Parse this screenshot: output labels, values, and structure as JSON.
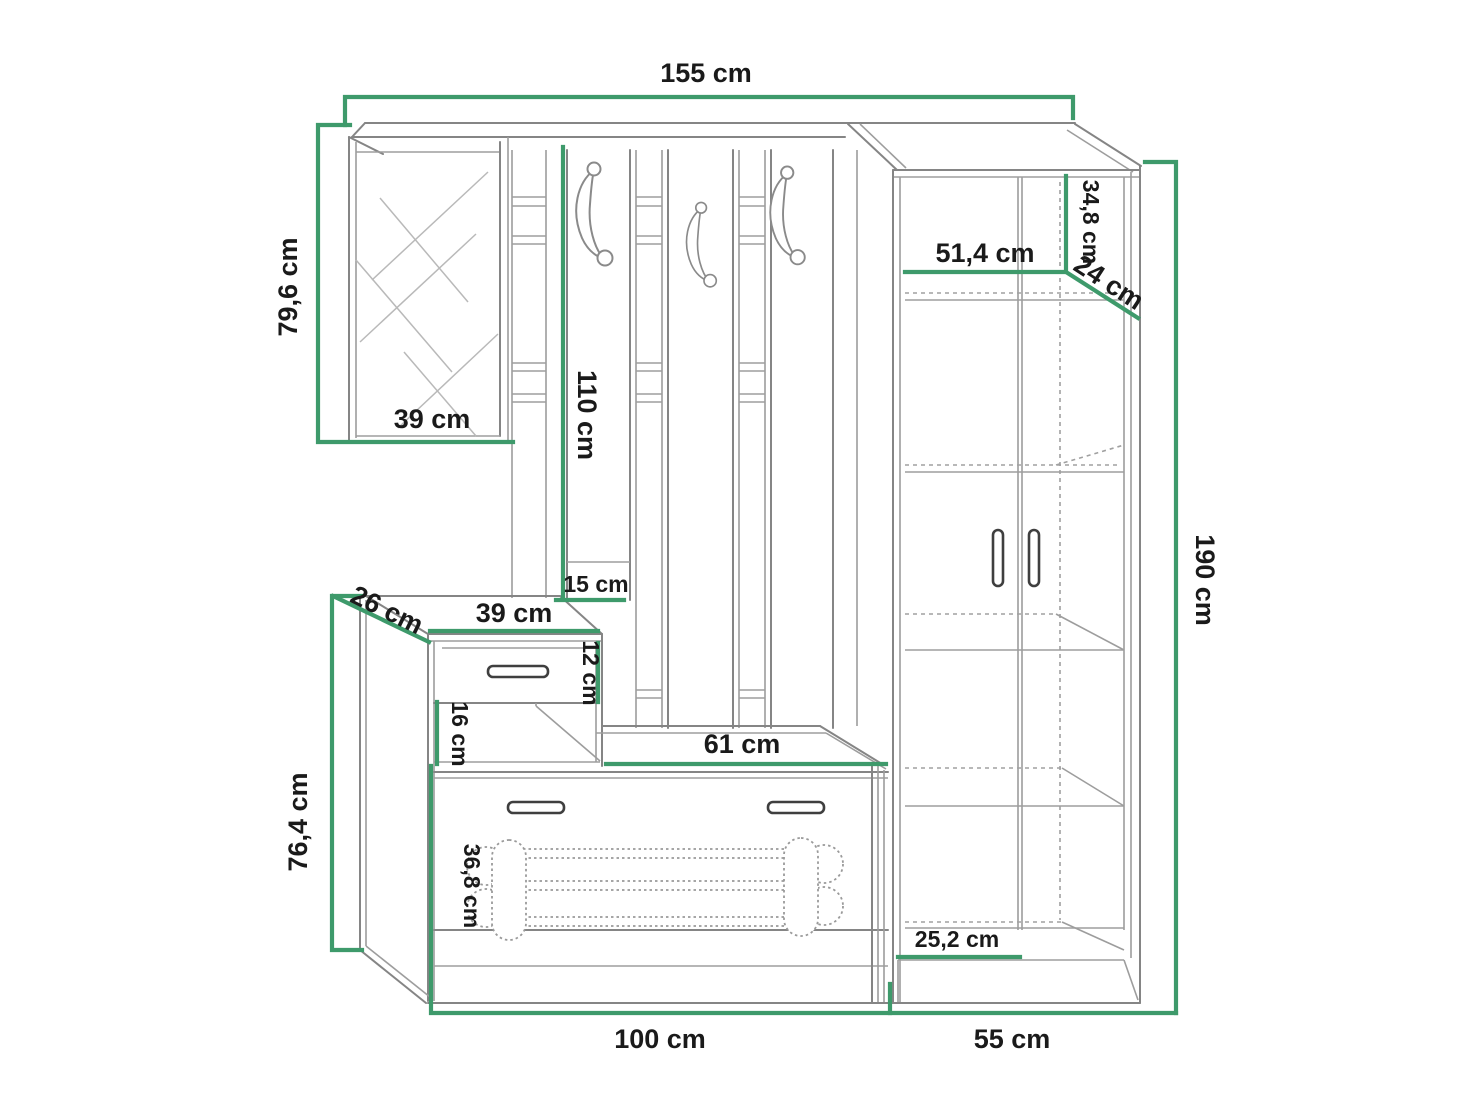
{
  "diagram": {
    "type": "furniture-dimension-drawing",
    "unit": "cm",
    "colors": {
      "dimension_line": "#3E9A6B",
      "furniture_outline": "#858585",
      "label_text": "#1a1a1a",
      "background": "#ffffff"
    },
    "dims": {
      "top_width": "155 cm",
      "mirror_height": "79,6 cm",
      "mirror_width": "39 cm",
      "hook_panel_height": "110 cm",
      "hook_panel_bottom": "15 cm",
      "top_shelf_height": "34,8 cm",
      "shelf_width": "51,4 cm",
      "shelf_depth": "24 cm",
      "total_height": "190 cm",
      "cabinet_depth": "26 cm",
      "cabinet_top_width": "39 cm",
      "drawer_height": "12 cm",
      "niche_height": "16 cm",
      "bench_width": "61 cm",
      "lower_left_height": "76,4 cm",
      "shoe_cabinet_height": "36,8 cm",
      "plinth_shelf_width": "25,2 cm",
      "base_width_left": "100 cm",
      "base_width_right": "55 cm"
    }
  }
}
